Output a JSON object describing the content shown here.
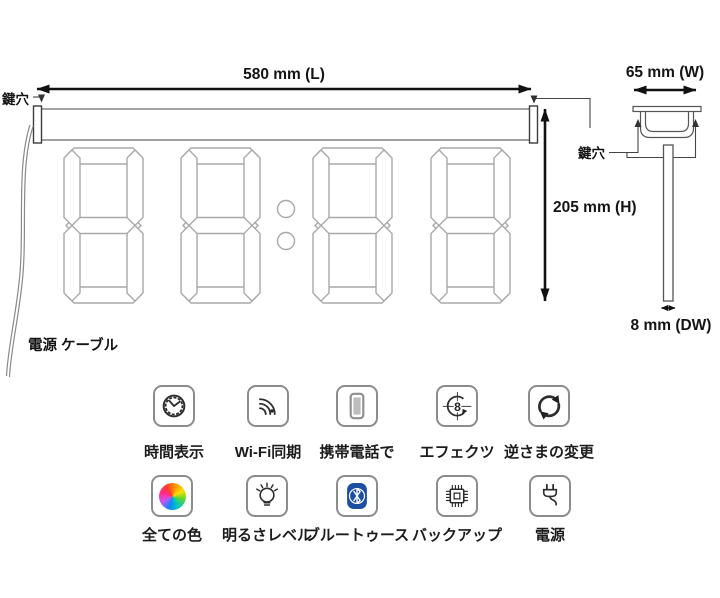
{
  "diagram": {
    "front_view": {
      "length_label": "580 mm (L)",
      "height_label": "205 mm (H)",
      "keyhole_label": "鍵穴",
      "power_cable_label": "電源 ケーブル",
      "digit_count": 4
    },
    "side_view": {
      "width_label": "65 mm (W)",
      "depth_label": "8 mm (DW)",
      "keyhole_label": "鍵穴"
    }
  },
  "features": {
    "row1": [
      {
        "icon": "clock-icon",
        "label": "時間表示"
      },
      {
        "icon": "wifi-icon",
        "label": "Wi-Fi同期"
      },
      {
        "icon": "mobile-phone-icon",
        "label": "携帯電話で"
      },
      {
        "icon": "effects-icon",
        "label": "エフェクツ"
      },
      {
        "icon": "flip-rotate-icon",
        "label": "逆さまの変更"
      }
    ],
    "row2": [
      {
        "icon": "color-wheel-icon",
        "label": "全ての色"
      },
      {
        "icon": "brightness-icon",
        "label": "明るさレベル"
      },
      {
        "icon": "bluetooth-icon",
        "label": "ブルートゥース"
      },
      {
        "icon": "chip-icon",
        "label": "バックアップ"
      },
      {
        "icon": "power-plug-icon",
        "label": "電源"
      }
    ]
  },
  "icon_details": {
    "effects_digit": "8"
  },
  "colors": {
    "background": "#ffffff",
    "ink": "#141414",
    "drawing_line_gray": "#8a8a8a",
    "bluetooth_blue": "#1c4fa1"
  }
}
